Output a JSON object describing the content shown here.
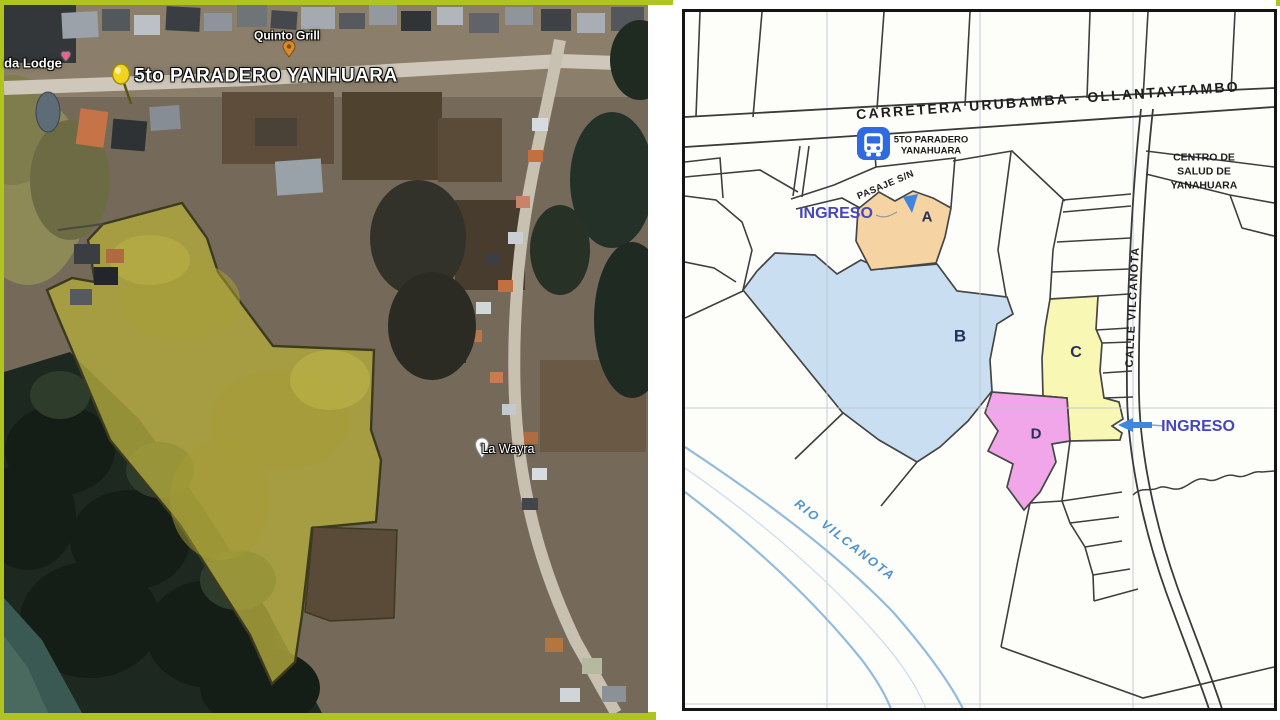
{
  "frame": {
    "color": "#b0c41f"
  },
  "satellite": {
    "pin_lodge": "da Lodge",
    "pin_grill": "Quinto Grill",
    "pin_stop": "5to PARADERO YANHUARA",
    "pin_wayra": "La Wayra",
    "highlight_color": "#b3aa3d"
  },
  "plan": {
    "carretera": "CARRETERA URUBAMBA - OLLANTAYTAMBO",
    "bus_stop_l1": "5TO PARADERO",
    "bus_stop_l2": "YANAHUARA",
    "centro_l1": "CENTRO DE",
    "centro_l2": "SALUD DE",
    "centro_l3": "YANAHUARA",
    "pasaje": "PASAJE S/N",
    "calle": "CALLE VILCANOTA",
    "rio": "RIO VILCANOTA",
    "ingreso_left": "INGRESO",
    "ingreso_right": "INGRESO",
    "lots": [
      {
        "id": "A",
        "color": "#f5d3a2"
      },
      {
        "id": "B",
        "color": "#c9def1"
      },
      {
        "id": "C",
        "color": "#f8f7b4"
      },
      {
        "id": "D",
        "color": "#f0a6e9"
      }
    ],
    "colors": {
      "ingreso": "#4646be",
      "lot_label": "#273058",
      "river_text": "#4f94cb",
      "bus_icon": "#2e6be0",
      "arrow": "#3f86df"
    }
  }
}
